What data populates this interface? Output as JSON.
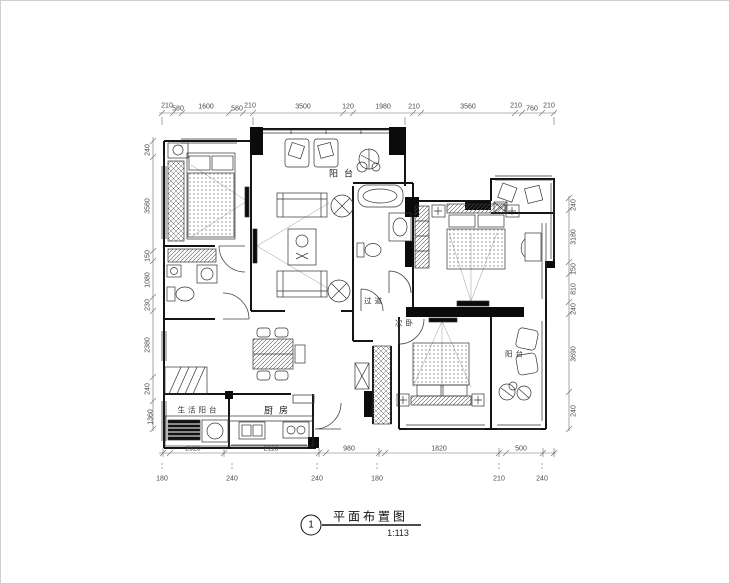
{
  "title_block": {
    "sheet_number": "1",
    "title": "平面布置图",
    "scale": "1:113"
  },
  "rooms": {
    "balcony_top": "阳台",
    "corridor": "过道",
    "bedroom_secondary": "次卧",
    "kitchen": "厨房",
    "service_balcony": "生活阳台",
    "balcony_right": "阳台"
  },
  "dimensions": {
    "top": [
      "210",
      "580",
      "1600",
      "580",
      "210",
      "3500",
      "120",
      "1980",
      "210",
      "3560",
      "210",
      "760",
      "210"
    ],
    "left": [
      "240",
      "3580",
      "150",
      "1080",
      "230",
      "2380",
      "240",
      "1360"
    ],
    "right": [
      "240",
      "3180",
      "150",
      "810",
      "240",
      "3690",
      "240"
    ],
    "bottom_inner": [
      "2920",
      "2110",
      "980",
      "1820",
      "500"
    ],
    "bottom_outer": [
      "180",
      "240",
      "240",
      "180",
      "210",
      "240"
    ]
  }
}
